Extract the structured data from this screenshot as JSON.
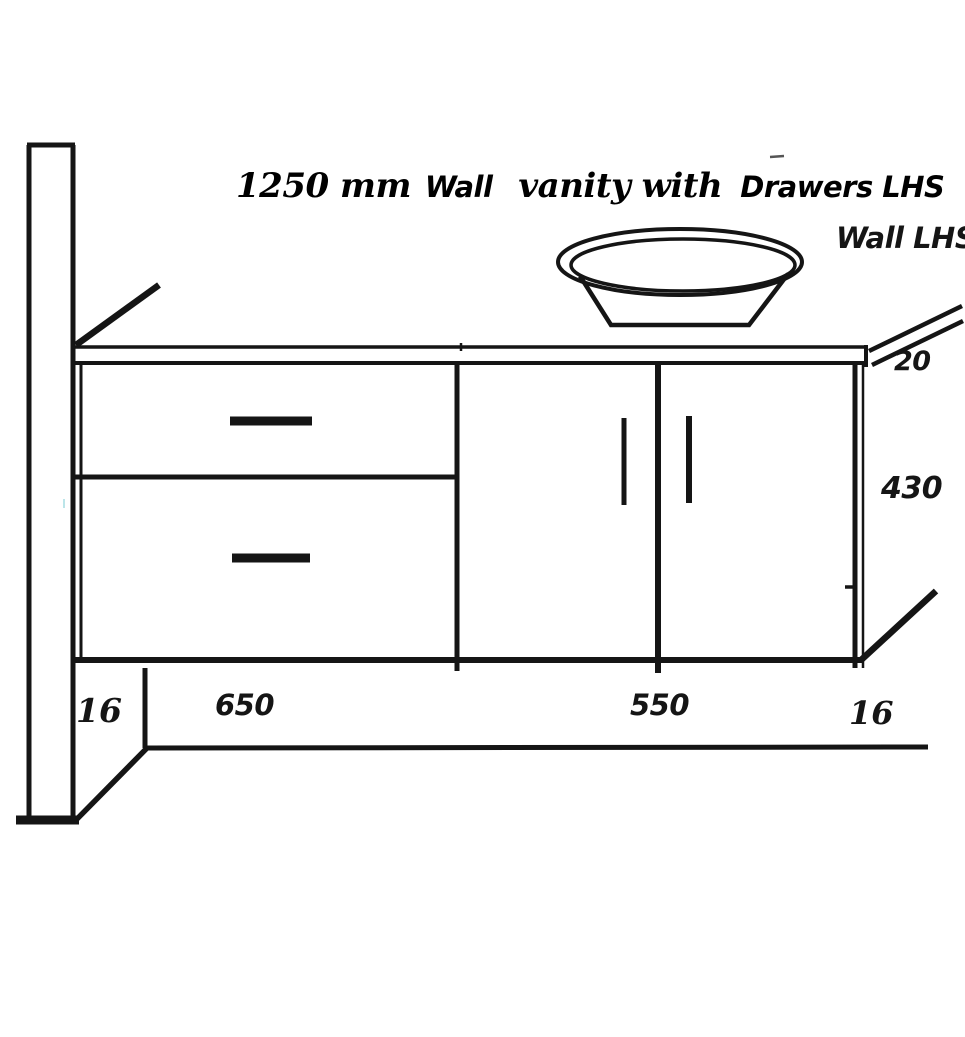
{
  "title": {
    "part1": "1250 mm",
    "part2": "Wall",
    "part3": "vanity with",
    "part4": "Drawers LHS"
  },
  "labels": {
    "wall_side": "Wall LHS",
    "counter_thickness": "20",
    "cabinet_height": "430",
    "left_panel_thickness": "16",
    "drawer_section_width": "650",
    "door_section_width": "550",
    "right_panel_thickness": "16"
  },
  "colors": {
    "ink": "#151515",
    "background": "#ffffff",
    "artifact_gray": "#555555",
    "artifact_cyan": "#8fd4da"
  }
}
